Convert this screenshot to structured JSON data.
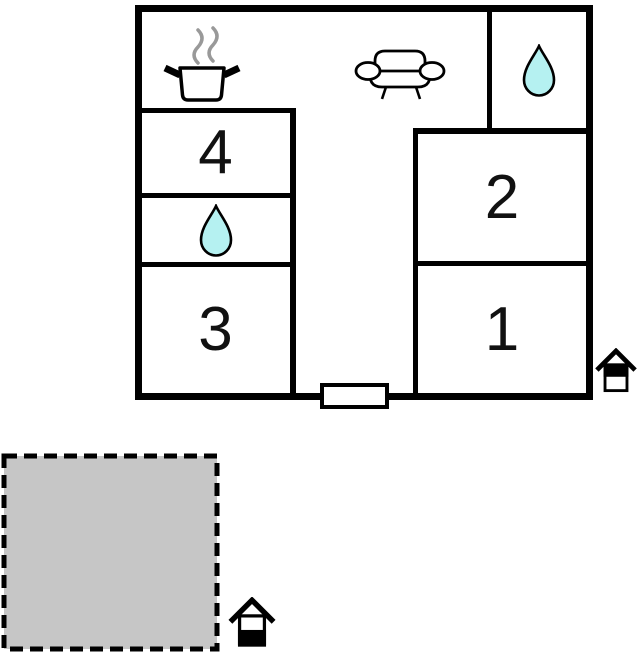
{
  "floorplan": {
    "title": "property floor plan",
    "rooms": [
      {
        "label": "1"
      },
      {
        "label": "2"
      },
      {
        "label": "3"
      },
      {
        "label": "4"
      }
    ],
    "icons": [
      {
        "name": "cooking-pot-steam-icon"
      },
      {
        "name": "sofa-icon"
      },
      {
        "name": "water-drop-icon-top-right"
      },
      {
        "name": "water-drop-icon-left"
      },
      {
        "name": "entrance-house-icon-right"
      },
      {
        "name": "entrance-house-icon-bottom"
      }
    ],
    "colors": {
      "wall": "#000000",
      "water_drop_fill": "#b5f1f1",
      "terrace_fill": "#c6c6c6",
      "steam": "#999999",
      "door_fill": "#ffffff",
      "background": "#ffffff"
    }
  }
}
